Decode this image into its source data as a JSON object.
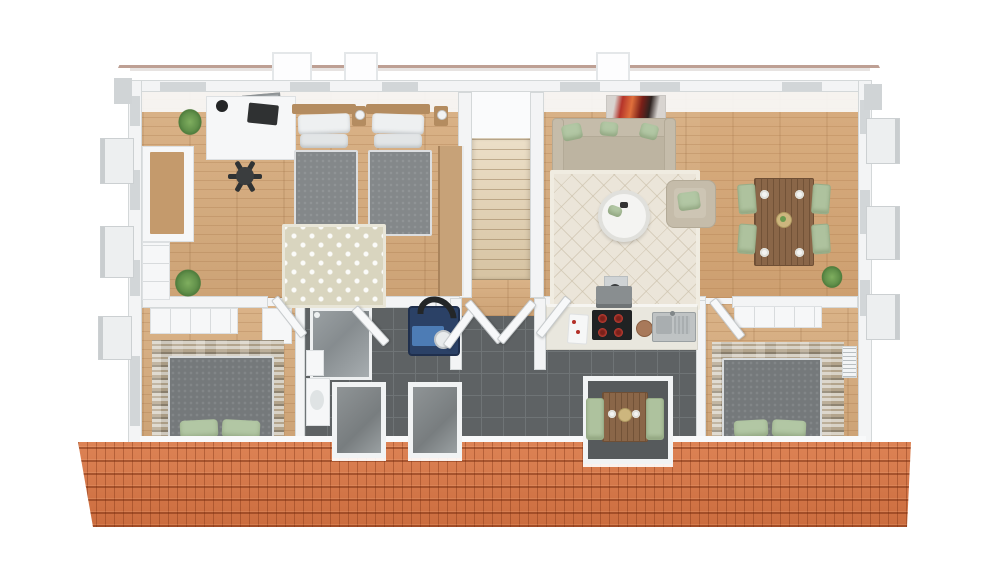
{
  "scene": {
    "title": "3D top-down floor plan rendering of an apartment upper floor",
    "style": "architectural 3D render, bird's-eye view",
    "background": "#ffffff",
    "text_visible": "none"
  },
  "palette": {
    "roofTile": "#cb6c3e",
    "roofHi": "#dd8355",
    "wallWhite": "#f3f4f5",
    "wallGray": "#d2d6d8",
    "woodLight": "#dab388",
    "woodMid": "#cda376",
    "tileDark": "#5e6264",
    "tileLine": "#6f7476",
    "stoneLight": "#d8d2c6",
    "stoneMid": "#b3a48c",
    "stoneDark": "#8f8471",
    "bedGray": "#75797b",
    "pillowGreen": "#b2c7a4",
    "sofaBeige": "#c5bcaa",
    "rugCream": "#ebe5d9",
    "rugPattern": "#d9d5bf",
    "stairBeige": "#e0d1b5",
    "tableBrown": "#8a6648",
    "chairGreen": "#aec29e",
    "applianceBlue": "#4d7cb5",
    "plantGreen": "#4e7c3c",
    "artRed": "#b5342a"
  },
  "roof": {
    "top_strip": {
      "tile_color": "#cb6c3e",
      "skylights": 3
    },
    "bottom_strip": {
      "tile_color": "#cb6c3e",
      "dormer_windows": 2,
      "kitchen_dormer_with_table": 1
    }
  },
  "rooms": [
    {
      "id": "office-twin-bedroom",
      "floor": "light wood",
      "contents": [
        "white desk",
        "monitor",
        "desk lamp",
        "black office chair",
        "wall picture",
        "two single beds with gray duvets",
        "white pillows",
        "wood nightstands with lamps",
        "diamond-pattern rug",
        "white wardrobe with wood top",
        "tall wood wardrobe",
        "two potted plants"
      ]
    },
    {
      "id": "stairwell",
      "floor": "white landing with beige staircase",
      "contents": [
        "staircase descending to hallway"
      ]
    },
    {
      "id": "living-dining-room",
      "floor": "light wood",
      "contents": [
        "red abstract wall art",
        "beige three-seat sofa",
        "three green cushions",
        "cream lattice rug",
        "round white coffee table",
        "beige armchair with green cushion",
        "brown dining table",
        "four green dining chairs",
        "white plates and center bowl",
        "potted plant"
      ]
    },
    {
      "id": "bedroom-lower-left",
      "floor": "light wood",
      "contents": [
        "white dresser",
        "white cabinet",
        "stone accent wall",
        "gray double bed",
        "two green pillows"
      ]
    },
    {
      "id": "bathroom-utility",
      "floor": "dark gray tile",
      "contents": [
        "glass shower",
        "white vanity with basin",
        "white shelf",
        "blue heat-pump laundry unit with black hose",
        "two gray dormer windows",
        "open white doors"
      ]
    },
    {
      "id": "hallway",
      "floor": "wood strip and dark gray tile",
      "contents": [
        "open double doors at stair foot"
      ]
    },
    {
      "id": "kitchen",
      "floor": "dark gray tile",
      "contents": [
        "chimney vent",
        "range hood",
        "black cooktop with four red burners",
        "cutting board",
        "round wood board",
        "stainless double sink",
        "beige counter",
        "dormer nook with bistro table",
        "two green chairs",
        "plates and bowl"
      ]
    },
    {
      "id": "bedroom-lower-right",
      "floor": "light wood",
      "contents": [
        "white wardrobe strip",
        "stone accent wall",
        "gray double bed",
        "two green pillows",
        "wall radiator"
      ]
    }
  ],
  "exterior": {
    "window_boxes_left": 3,
    "window_boxes_right": 3,
    "top_wall_windows": 6
  }
}
